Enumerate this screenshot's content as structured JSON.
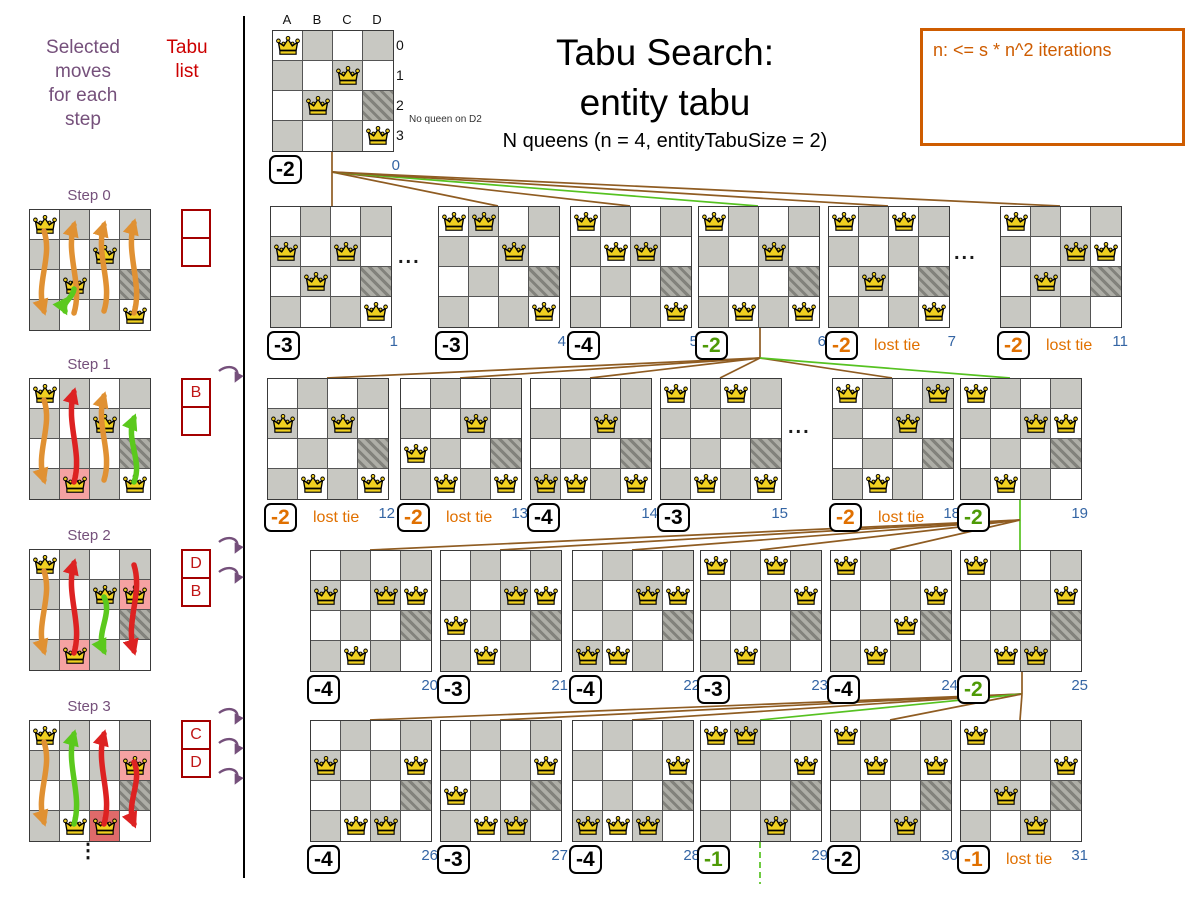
{
  "palette": {
    "purple": "#75507b",
    "red_dark": "#a40000",
    "red_letter": "#c01616",
    "blue": "#3465a4",
    "orange": "#e07000",
    "note_orange": "#ce5c00",
    "green_text": "#4e9a06",
    "green_line": "#56c221",
    "brown_line": "#8f5c22",
    "gray_cell": "#c8c8c2",
    "pink_cell": "#f5a2a2",
    "red_cell": "#df6a6a",
    "queen_gold": "#f0d020",
    "arrow_orange": "#e09133",
    "arrow_red": "#dd2222",
    "arrow_green": "#5bc91d"
  },
  "header": {
    "title_line1": "Tabu Search:",
    "title_line2": "entity tabu",
    "subtitle": "N queens (n = 4, entityTabuSize = 2)",
    "note": "n: <= s * n^2 iterations"
  },
  "left_panel": {
    "moves_label": "Selected\nmoves\nfor each\nstep",
    "tabu_label": "Tabu\nlist",
    "ellipsis": "⋮",
    "steps": [
      {
        "label": "Step 0",
        "y": 209,
        "queens": [
          "A0",
          "C1",
          "B2",
          "D3"
        ],
        "highlights": {},
        "tabu": [
          "",
          ""
        ],
        "curls": 0,
        "arrows": [
          {
            "col": 0,
            "color": "orange",
            "y1": 22,
            "y2": 102
          },
          {
            "col": 1,
            "color": "orange",
            "y1": 104,
            "y2": 16
          },
          {
            "col": 2,
            "color": "orange",
            "y1": 102,
            "y2": 16
          },
          {
            "col": 3,
            "color": "orange",
            "y1": 104,
            "y2": 14
          },
          {
            "col": 1,
            "color": "green",
            "y1": 80,
            "y2": 102,
            "short": true
          }
        ]
      },
      {
        "label": "Step 1",
        "y": 378,
        "queens": [
          "A0",
          "C1",
          "B3",
          "D3"
        ],
        "highlights": {
          "B3": "pink"
        },
        "tabu": [
          "B",
          ""
        ],
        "curls": 1,
        "arrows": [
          {
            "col": 0,
            "color": "orange",
            "y1": 22,
            "y2": 102
          },
          {
            "col": 1,
            "color": "red",
            "y1": 104,
            "y2": 14
          },
          {
            "col": 2,
            "color": "orange",
            "y1": 102,
            "y2": 18
          },
          {
            "col": 3,
            "color": "green",
            "y1": 104,
            "y2": 40
          }
        ]
      },
      {
        "label": "Step 2",
        "y": 549,
        "queens": [
          "A0",
          "C1",
          "D1",
          "B3"
        ],
        "highlights": {
          "B3": "pink",
          "D1": "pink"
        },
        "tabu": [
          "D",
          "B"
        ],
        "curls": 2,
        "arrows": [
          {
            "col": 0,
            "color": "orange",
            "y1": 22,
            "y2": 102
          },
          {
            "col": 1,
            "color": "red",
            "y1": 104,
            "y2": 14
          },
          {
            "col": 2,
            "color": "green",
            "y1": 48,
            "y2": 102
          },
          {
            "col": 3,
            "color": "red",
            "y1": 16,
            "y2": 102
          }
        ]
      },
      {
        "label": "Step 3",
        "y": 720,
        "queens": [
          "A0",
          "D1",
          "B3",
          "C3"
        ],
        "highlights": {
          "D1": "pink",
          "C3": "redcell"
        },
        "tabu": [
          "C",
          "D"
        ],
        "curls": 3,
        "arrows": [
          {
            "col": 0,
            "color": "orange",
            "y1": 22,
            "y2": 102
          },
          {
            "col": 1,
            "color": "green",
            "y1": 104,
            "y2": 14
          },
          {
            "col": 2,
            "color": "red",
            "y1": 104,
            "y2": 14
          },
          {
            "col": 3,
            "color": "red",
            "y1": 42,
            "y2": 104
          }
        ]
      }
    ]
  },
  "start_board": {
    "x": 272,
    "y": 30,
    "queens": [
      "A0",
      "C1",
      "B2",
      "D3"
    ],
    "score": "-2",
    "score_color": "black",
    "index": "0",
    "col_labels": [
      "A",
      "B",
      "C",
      "D"
    ],
    "row_labels": [
      "0",
      "1",
      "2",
      "3"
    ],
    "annotation": "No queen on D2"
  },
  "lost_tie_label": "lost tie",
  "ellipses": [
    {
      "t": "..."
    },
    {
      "t": "..."
    },
    {
      "t": "..."
    }
  ],
  "rows": [
    {
      "y": 206,
      "boards": [
        {
          "x": 270,
          "queens": [
            "A1",
            "C1",
            "B2",
            "D3"
          ],
          "score": "-3",
          "score_color": "black",
          "index": "1"
        },
        {
          "x": 438,
          "queens": [
            "A0",
            "B0",
            "C1",
            "D3"
          ],
          "score": "-3",
          "score_color": "black",
          "index": "4"
        },
        {
          "x": 570,
          "queens": [
            "A0",
            "B1",
            "C1",
            "D3"
          ],
          "score": "-4",
          "score_color": "black",
          "index": "5"
        },
        {
          "x": 698,
          "queens": [
            "A0",
            "C1",
            "B3",
            "D3"
          ],
          "score": "-2",
          "score_color": "green",
          "index": "6"
        },
        {
          "x": 828,
          "queens": [
            "A0",
            "C0",
            "B2",
            "D3"
          ],
          "score": "-2",
          "score_color": "orange",
          "lost_tie": true,
          "index": "7"
        },
        {
          "x": 1000,
          "queens": [
            "A0",
            "C1",
            "D1",
            "B2"
          ],
          "score": "-2",
          "score_color": "orange",
          "lost_tie": true,
          "index": "11"
        }
      ]
    },
    {
      "y": 378,
      "boards": [
        {
          "x": 267,
          "queens": [
            "A1",
            "C1",
            "B3",
            "D3"
          ],
          "score": "-2",
          "score_color": "orange",
          "lost_tie": true,
          "index": "12"
        },
        {
          "x": 400,
          "queens": [
            "A2",
            "C1",
            "B3",
            "D3"
          ],
          "score": "-2",
          "score_color": "orange",
          "lost_tie": true,
          "index": "13"
        },
        {
          "x": 530,
          "queens": [
            "A3",
            "C1",
            "B3",
            "D3"
          ],
          "score": "-4",
          "score_color": "black",
          "index": "14"
        },
        {
          "x": 660,
          "queens": [
            "A0",
            "C0",
            "B3",
            "D3"
          ],
          "score": "-3",
          "score_color": "black",
          "index": "15"
        },
        {
          "x": 832,
          "queens": [
            "A0",
            "C1",
            "B3",
            "D0"
          ],
          "score": "-2",
          "score_color": "orange",
          "lost_tie": true,
          "index": "18"
        },
        {
          "x": 960,
          "queens": [
            "A0",
            "C1",
            "D1",
            "B3"
          ],
          "score": "-2",
          "score_color": "green",
          "index": "19"
        }
      ]
    },
    {
      "y": 550,
      "boards": [
        {
          "x": 310,
          "queens": [
            "A1",
            "C1",
            "D1",
            "B3"
          ],
          "score": "-4",
          "score_color": "black",
          "index": "20"
        },
        {
          "x": 440,
          "queens": [
            "A2",
            "C1",
            "D1",
            "B3"
          ],
          "score": "-3",
          "score_color": "black",
          "index": "21"
        },
        {
          "x": 572,
          "queens": [
            "A3",
            "C1",
            "D1",
            "B3"
          ],
          "score": "-4",
          "score_color": "black",
          "index": "22"
        },
        {
          "x": 700,
          "queens": [
            "A0",
            "C0",
            "D1",
            "B3"
          ],
          "score": "-3",
          "score_color": "black",
          "index": "23"
        },
        {
          "x": 830,
          "queens": [
            "A0",
            "C2",
            "D1",
            "B3"
          ],
          "score": "-4",
          "score_color": "black",
          "index": "24"
        },
        {
          "x": 960,
          "queens": [
            "A0",
            "C3",
            "D1",
            "B3"
          ],
          "score": "-2",
          "score_color": "green",
          "index": "25"
        }
      ]
    },
    {
      "y": 720,
      "boards": [
        {
          "x": 310,
          "queens": [
            "A1",
            "D1",
            "B3",
            "C3"
          ],
          "score": "-4",
          "score_color": "black",
          "index": "26"
        },
        {
          "x": 440,
          "queens": [
            "A2",
            "D1",
            "B3",
            "C3"
          ],
          "score": "-3",
          "score_color": "black",
          "index": "27"
        },
        {
          "x": 572,
          "queens": [
            "A3",
            "D1",
            "B3",
            "C3"
          ],
          "score": "-4",
          "score_color": "black",
          "index": "28"
        },
        {
          "x": 700,
          "queens": [
            "A0",
            "B0",
            "D1",
            "C3"
          ],
          "score": "-1",
          "score_color": "green",
          "index": "29"
        },
        {
          "x": 830,
          "queens": [
            "A0",
            "B1",
            "D1",
            "C3"
          ],
          "score": "-2",
          "score_color": "black",
          "index": "30"
        },
        {
          "x": 960,
          "queens": [
            "A0",
            "B2",
            "D1",
            "C3"
          ],
          "score": "-1",
          "score_color": "orange",
          "lost_tie": true,
          "index": "31"
        }
      ]
    }
  ],
  "edges": [
    {
      "x1": 332,
      "y1": 150,
      "x2": 332,
      "y2": 172,
      "color": "brown"
    },
    {
      "x1": 332,
      "y1": 172,
      "x2": 332,
      "y2": 206,
      "color": "brown"
    },
    {
      "x1": 332,
      "y1": 172,
      "x2": 498,
      "y2": 206,
      "color": "brown"
    },
    {
      "x1": 332,
      "y1": 172,
      "x2": 630,
      "y2": 206,
      "color": "brown"
    },
    {
      "x1": 332,
      "y1": 172,
      "x2": 758,
      "y2": 206,
      "color": "green"
    },
    {
      "x1": 332,
      "y1": 172,
      "x2": 888,
      "y2": 206,
      "color": "brown"
    },
    {
      "x1": 332,
      "y1": 172,
      "x2": 1060,
      "y2": 206,
      "color": "brown"
    },
    {
      "x1": 760,
      "y1": 326,
      "x2": 760,
      "y2": 358,
      "color": "brown"
    },
    {
      "x1": 760,
      "y1": 358,
      "x2": 327,
      "y2": 378,
      "color": "brown"
    },
    {
      "x1": 760,
      "y1": 358,
      "x2": 460,
      "y2": 378,
      "color": "brown"
    },
    {
      "x1": 760,
      "y1": 358,
      "x2": 590,
      "y2": 378,
      "color": "brown"
    },
    {
      "x1": 760,
      "y1": 358,
      "x2": 720,
      "y2": 378,
      "color": "brown"
    },
    {
      "x1": 760,
      "y1": 358,
      "x2": 892,
      "y2": 378,
      "color": "brown"
    },
    {
      "x1": 760,
      "y1": 358,
      "x2": 1010,
      "y2": 378,
      "color": "green"
    },
    {
      "x1": 1020,
      "y1": 498,
      "x2": 1020,
      "y2": 550,
      "color": "green"
    },
    {
      "x1": 1020,
      "y1": 520,
      "x2": 370,
      "y2": 550,
      "color": "brown"
    },
    {
      "x1": 1020,
      "y1": 520,
      "x2": 500,
      "y2": 550,
      "color": "brown"
    },
    {
      "x1": 1020,
      "y1": 520,
      "x2": 632,
      "y2": 550,
      "color": "brown"
    },
    {
      "x1": 1020,
      "y1": 520,
      "x2": 760,
      "y2": 550,
      "color": "brown"
    },
    {
      "x1": 1020,
      "y1": 520,
      "x2": 890,
      "y2": 550,
      "color": "brown"
    },
    {
      "x1": 1022,
      "y1": 670,
      "x2": 1022,
      "y2": 694,
      "color": "brown"
    },
    {
      "x1": 1022,
      "y1": 694,
      "x2": 370,
      "y2": 720,
      "color": "brown"
    },
    {
      "x1": 1022,
      "y1": 694,
      "x2": 500,
      "y2": 720,
      "color": "brown"
    },
    {
      "x1": 1022,
      "y1": 694,
      "x2": 632,
      "y2": 720,
      "color": "brown"
    },
    {
      "x1": 1022,
      "y1": 694,
      "x2": 760,
      "y2": 720,
      "color": "green"
    },
    {
      "x1": 1022,
      "y1": 694,
      "x2": 890,
      "y2": 720,
      "color": "brown"
    },
    {
      "x1": 1022,
      "y1": 694,
      "x2": 1020,
      "y2": 720,
      "color": "brown"
    },
    {
      "x1": 760,
      "y1": 842,
      "x2": 760,
      "y2": 884,
      "color": "green",
      "dashed": true
    }
  ]
}
